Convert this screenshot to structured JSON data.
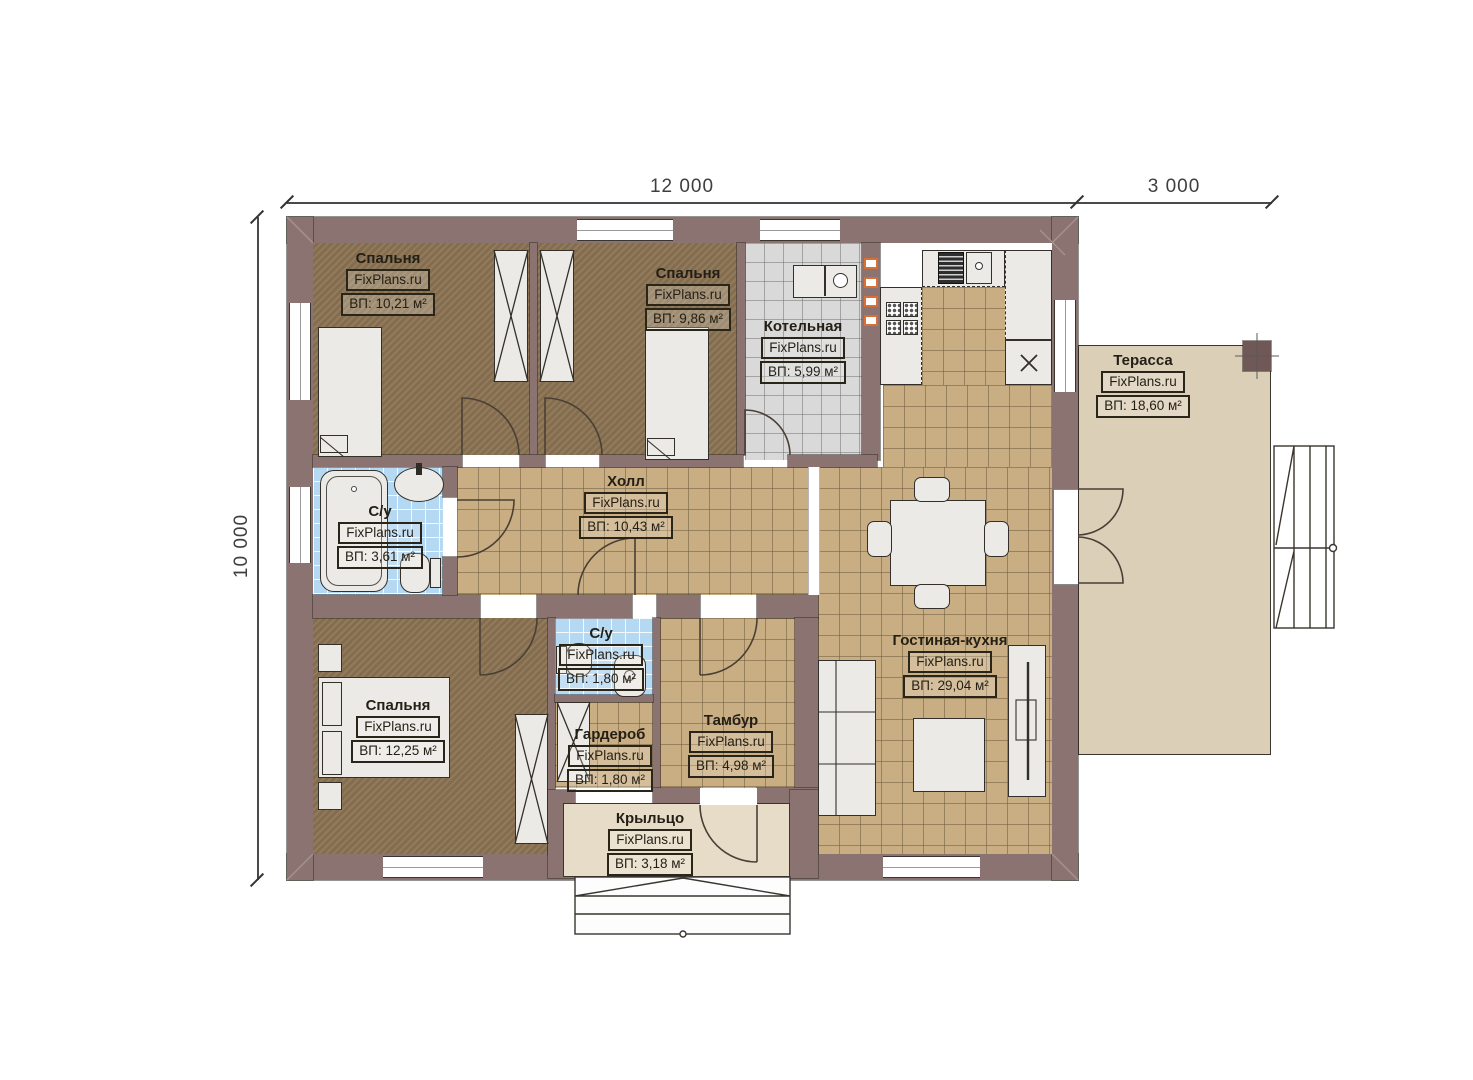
{
  "watermark": "FixPlans.ru",
  "dimensions": {
    "width_main": "12 000",
    "width_terrace": "3 000",
    "height": "10 000"
  },
  "rooms": [
    {
      "id": "bedroom-1",
      "name": "Спальня",
      "area": "ВП: 10,21 м²"
    },
    {
      "id": "bedroom-2",
      "name": "Спальня",
      "area": "ВП: 9,86 м²"
    },
    {
      "id": "boiler",
      "name": "Котельная",
      "area": "ВП: 5,99 м²"
    },
    {
      "id": "terrace",
      "name": "Терасса",
      "area": "ВП: 18,60 м²"
    },
    {
      "id": "hall",
      "name": "Холл",
      "area": "ВП: 10,43 м²"
    },
    {
      "id": "bath-1",
      "name": "С/у",
      "area": "ВП: 3,61 м²"
    },
    {
      "id": "bath-2",
      "name": "С/у",
      "area": "ВП: 1,80 м²"
    },
    {
      "id": "bedroom-3",
      "name": "Спальня",
      "area": "ВП: 12,25 м²"
    },
    {
      "id": "wardrobe",
      "name": "Гардероб",
      "area": "ВП: 1,80 м²"
    },
    {
      "id": "tambour",
      "name": "Тамбур",
      "area": "ВП: 4,98 м²"
    },
    {
      "id": "living",
      "name": "Гостиная-кухня",
      "area": "ВП: 29,04 м²"
    },
    {
      "id": "porch",
      "name": "Крыльцо",
      "area": "ВП: 3,18 м²"
    }
  ],
  "colors": {
    "wall": "#8a7370",
    "wall_dark": "#6f5855",
    "bedroom_floor": "#8c7454",
    "tile_floor": "#c9ae83",
    "boiler_floor": "#d9d9d9",
    "bath_floor": "#b5d8f3",
    "terrace_floor": "#dbcfb8",
    "porch_floor": "#e7dcc7",
    "furniture": "#eceae6",
    "vent": "#d96f35",
    "dim_text": "#3f3f3f"
  }
}
